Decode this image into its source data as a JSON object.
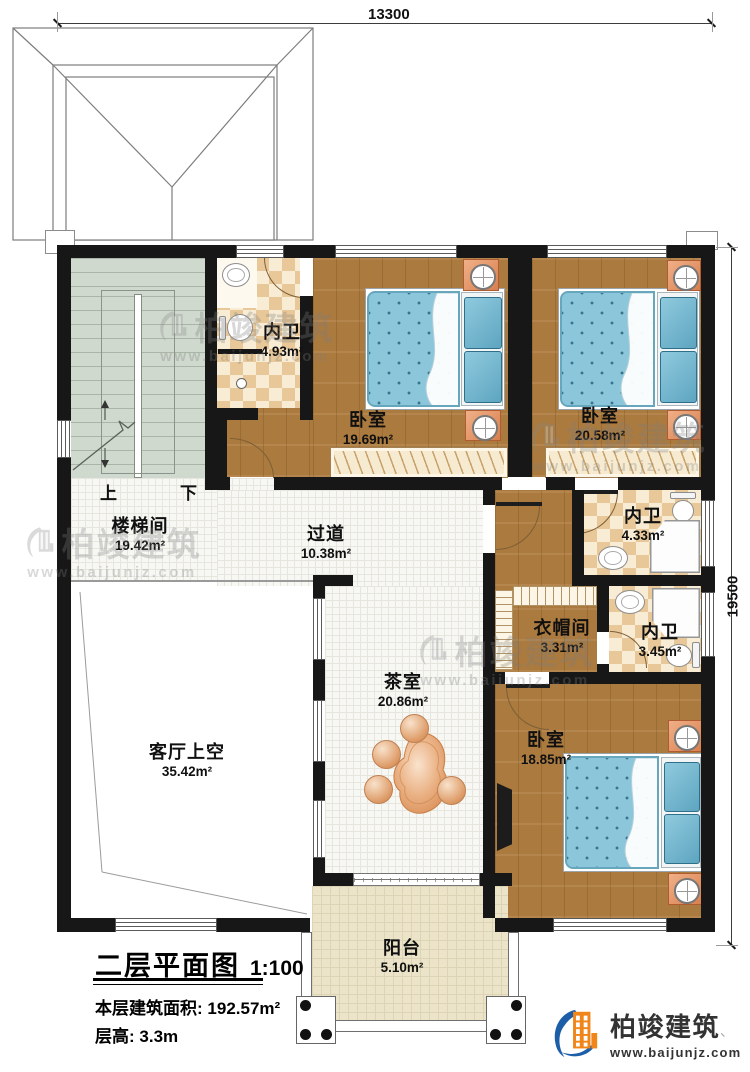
{
  "plan": {
    "dimensions": {
      "width_mm": "13300",
      "height_mm": "19500"
    },
    "stairs": {
      "up": "上",
      "down": "下"
    },
    "rooms": [
      {
        "key": "bath1",
        "name": "内卫",
        "area": "4.93m²"
      },
      {
        "key": "bedroom1",
        "name": "卧室",
        "area": "19.69m²"
      },
      {
        "key": "bedroom2",
        "name": "卧室",
        "area": "20.58m²"
      },
      {
        "key": "stairhall",
        "name": "楼梯间",
        "area": "19.42m²"
      },
      {
        "key": "hallway",
        "name": "过道",
        "area": "10.38m²"
      },
      {
        "key": "bath2",
        "name": "内卫",
        "area": "4.33m²"
      },
      {
        "key": "closet",
        "name": "衣帽间",
        "area": "3.31m²"
      },
      {
        "key": "bath3",
        "name": "内卫",
        "area": "3.45m²"
      },
      {
        "key": "tearoom",
        "name": "茶室",
        "area": "20.86m²"
      },
      {
        "key": "livingvoid",
        "name": "客厅上空",
        "area": "35.42m²"
      },
      {
        "key": "bedroom3",
        "name": "卧室",
        "area": "18.85m²"
      },
      {
        "key": "balcony",
        "name": "阳台",
        "area": "5.10m²"
      }
    ]
  },
  "title_block": {
    "title": "二层平面图",
    "scale": "1:100",
    "area_label": "本层建筑面积:",
    "area_value": "192.57m²",
    "floor_height_label": "层高:",
    "floor_height_value": "3.3m"
  },
  "branding": {
    "company": "柏竣建筑",
    "tick": "、",
    "website": "www.baijunjz.com"
  },
  "watermark": {
    "text": "柏竣建筑",
    "website": "www.baijunjz.com"
  },
  "colors": {
    "wall": "#171717",
    "wood": "#ab7a3e",
    "tile_light": "#f8ecd4",
    "tile_dark": "#e8c898",
    "stair_floor": "#cfd9cd",
    "bed_blue": "#8cc6da",
    "nightstand_orange": "#e8956a",
    "balcony_floor": "#ebe4c8",
    "logo_blue": "#1c5fa8",
    "logo_orange": "#f08519"
  }
}
